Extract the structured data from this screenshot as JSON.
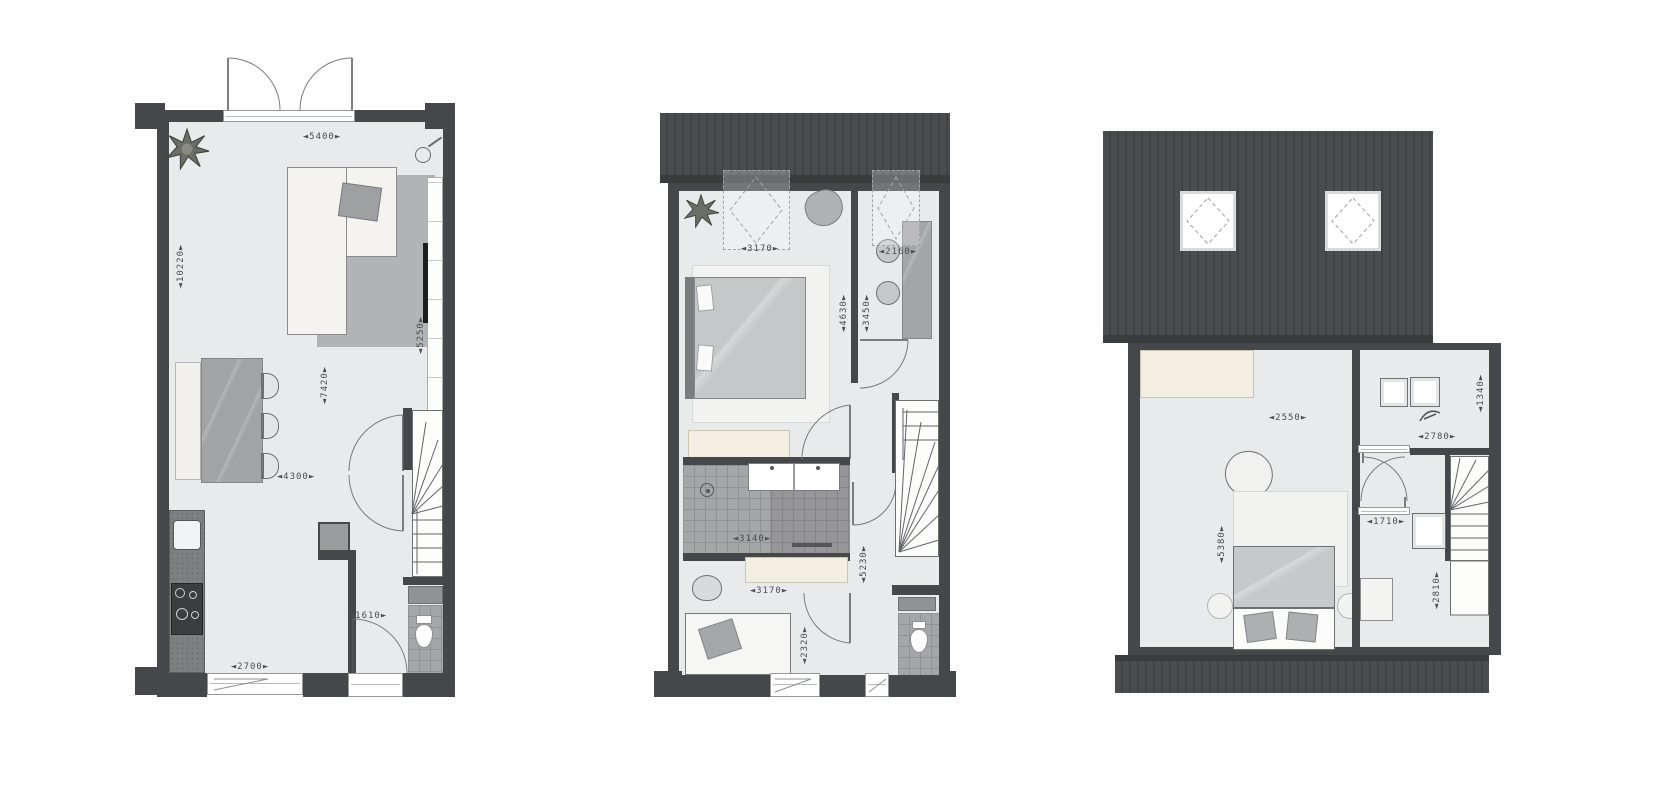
{
  "colors": {
    "wall": "#46474a",
    "roof": "#4a4b4d",
    "floor": "#e9eaeb",
    "tile_floor": "#a5a6a8",
    "cabinet_cream": "#f2efe2",
    "rug_gray": "#b2b3b5",
    "blanket_gray": "#c6c7c9",
    "tv_black": "#1c1d1f"
  },
  "plans": {
    "ground": {
      "dims": {
        "top_width": "◄5400►",
        "left_depth": "◄10220►",
        "right_depth": "◄5250►",
        "living_depth": "◄7420►",
        "dining_width": "◄4300►",
        "hall_width": "◄1610►",
        "kitchen_width": "◄2700►"
      }
    },
    "first": {
      "dims": {
        "master_width": "◄3170►",
        "study_width": "◄2160►",
        "master_depth": "◄4630►",
        "study_depth": "◄3450►",
        "bath_width": "◄3140►",
        "landing_depth": "◄5230►",
        "bedroom2_width": "◄3170►",
        "bedroom2_depth": "◄2320►"
      }
    },
    "attic": {
      "dims": {
        "bedroom_width": "◄2550►",
        "study_width": "◄2780►",
        "study_depth": "◄1340►",
        "bedroom_depth": "◄5380►",
        "hall_width": "◄1710►",
        "laundry_depth": "◄2810►"
      }
    }
  }
}
